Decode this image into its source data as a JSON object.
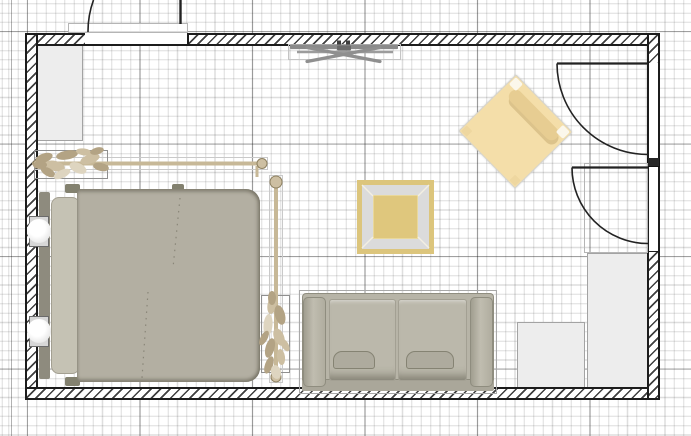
{
  "app": {
    "name": "2d-floor-plan-canvas",
    "view": "top-down",
    "canvas_width": 691,
    "canvas_height": 436
  },
  "colors": {
    "grid_minor": "rgba(0,0,0,0.13)",
    "grid_major": "rgba(0,0,0,0.30)",
    "wall_stroke": "#1c1c1c",
    "wall_hatch": "#3f3f3f",
    "cabinet_fill": "#ededed",
    "cabinet_border": "#a3a3a3",
    "bed_duvet": "#b3afa2",
    "bed_headboard": "#8e8b7e",
    "bed_pillow": "#c5c2b4",
    "bed_foot": "#83816f",
    "sofa_base": "#b7b4a7",
    "sofa_arm": "#b0ad9f",
    "sofa_cushion": "#bbb8ab",
    "sofa_pillow": "#aeab9e",
    "sofa_edge": "#8f8d7f",
    "chair_fill": "#f4dea9",
    "chair_back": "#e7cd92",
    "chair_cap": "#fbf7eb",
    "rug_border": "#dcc57c",
    "rug_bevel": "#dbdbdb",
    "rug_center": "#dfc77d",
    "rod": "#c7b897",
    "rod_dark": "#8d8060",
    "leaf_a": "#cdbfa2",
    "leaf_b": "#b3a384",
    "leaf_c": "#ded5c0",
    "door_stroke": "#222222",
    "frame_stroke": "#b5b5b5",
    "tv_gray": "#8a8a8a",
    "lamp_box": "#d7d7d7"
  },
  "room": {
    "wall_style": "hatched",
    "openings": [
      {
        "id": "entry-door-top",
        "type": "door",
        "wall": "top",
        "swing": "outward"
      },
      {
        "id": "door-right-upper",
        "type": "door",
        "wall": "right",
        "swing": "inward"
      },
      {
        "id": "door-right-lower",
        "type": "door",
        "wall": "right",
        "swing": "inward"
      }
    ]
  },
  "furniture": [
    {
      "id": "wardrobe-top-left",
      "type": "wardrobe"
    },
    {
      "id": "flat-screen-tv",
      "type": "television",
      "location": "top-wall"
    },
    {
      "id": "accent-armchair",
      "type": "armchair",
      "rotation_deg": 45
    },
    {
      "id": "square-area-rug",
      "type": "rug"
    },
    {
      "id": "double-bed",
      "type": "bed"
    },
    {
      "id": "bedside-lamp-upper",
      "type": "nightstand-lamp"
    },
    {
      "id": "bedside-lamp-lower",
      "type": "nightstand-lamp"
    },
    {
      "id": "curtain-rod-top",
      "type": "curtain-rod-garland"
    },
    {
      "id": "curtain-rod-side",
      "type": "curtain-rod-garland"
    },
    {
      "id": "two-seat-sofa",
      "type": "sofa",
      "seats": 2
    },
    {
      "id": "cabinet-tall-right",
      "type": "cabinet"
    },
    {
      "id": "cabinet-short-right",
      "type": "cabinet"
    }
  ]
}
